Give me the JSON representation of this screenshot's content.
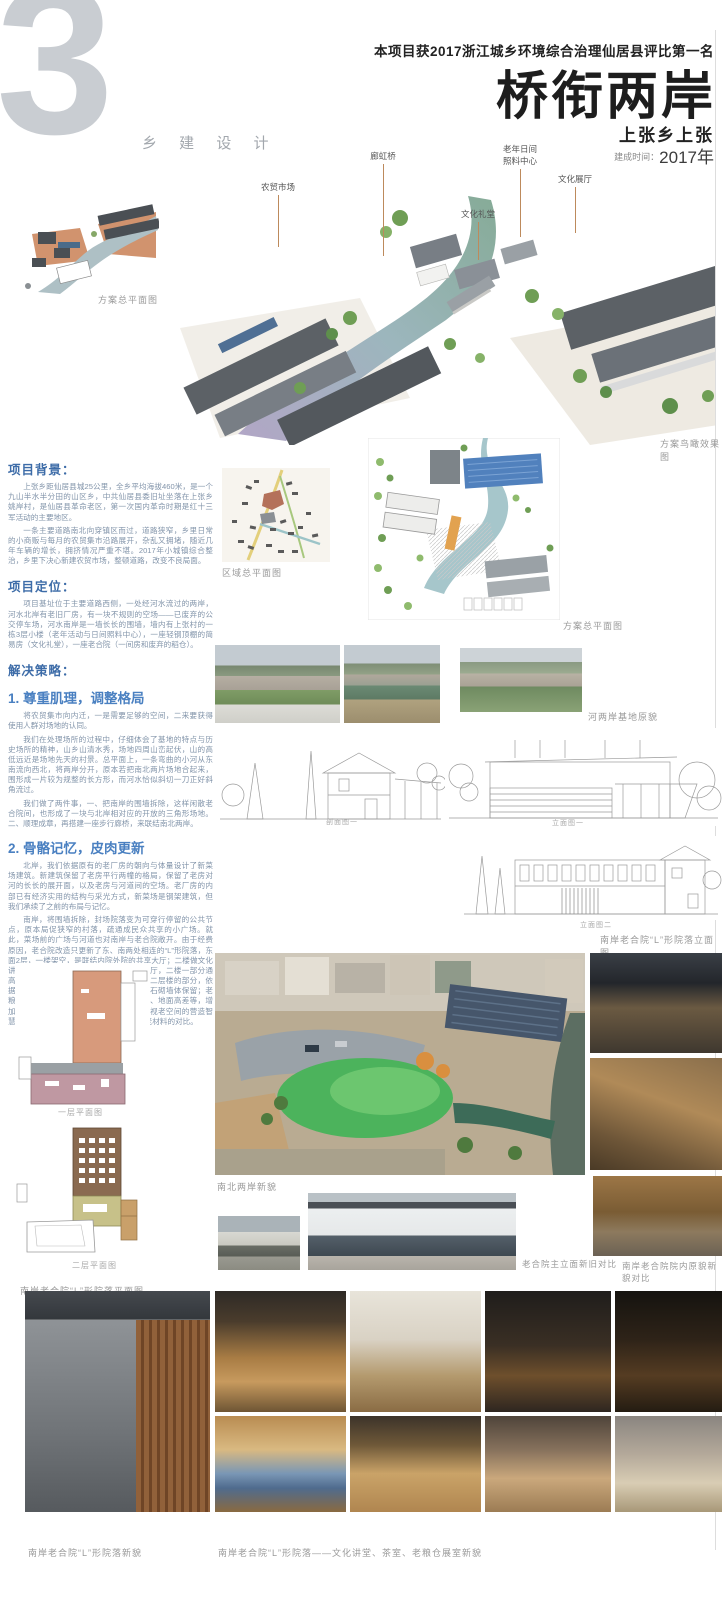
{
  "header": {
    "chapter_number": "3",
    "chapter_label": "乡 建 设 计",
    "award": "本项目获2017浙江城乡环境综合治理仙居县评比第一名",
    "title": "桥衔两岸",
    "subtitle": "上张乡上张",
    "date_label": "建成时间：",
    "date_value": "2017年"
  },
  "hero": {
    "caption": "方案鸟瞰效果图",
    "labels": [
      "农贸市场",
      "廊虹桥",
      "文化礼堂",
      "老年日间照料中心",
      "文化展厅"
    ]
  },
  "sections": {
    "background": {
      "title": "项目背景：",
      "p1": "上张乡距仙居县城25公里，全乡平均海拔460米，是一个九山半水半分田的山区乡，中共仙居县委旧址坐落在上张乡姚岸村，是仙居县革命老区，第一次国内革命时期是红十三军活动的主要地区。",
      "p2": "一条主要道路南北向穿镇区而过，道路狭窄，乡里日常的小商贩与每月的农贸集市沿路展开，杂乱又拥堵，随近几年车辆的增长，拥挤情况严重不堪。2017年小城镇综合整治，乡里下决心新建农贸市场，整顿道路，改变不良局面。"
    },
    "positioning": {
      "title": "项目定位：",
      "p1": "项目基址位于主要道路西侧，一处经河水流过的两岸，河水北岸有老旧厂房，有一块不规则的空场——已废弃的公交停车场，河水南岸是一墙长长的围墙，墙内有上张村的一栋3层小楼（老年活动与日间照料中心），一座轻钢顶棚的简易房（文化礼堂），一座老合院（一间房和废弃的稻仓）。"
    },
    "strategy": {
      "title": "解决策略：",
      "s1": {
        "title": "1. 尊重肌理，调整格局",
        "p1": "将农贸集市向内迁，一是需要足够的空间，二来要获得使用人群对场地的认同。",
        "p2": "我们在处理场所的过程中，仔细体会了基地的特点与历史场所的精神，山乡山清水秀，场地四周山峦起伏，山的高低远近是场地先天的村景。总平面上，一条弯曲的小河从东南流向西北，将两岸分开，原本若把南北两片场地合起来，围形成一片较为规整的长方形，而河水恰似斜切一刀正好斜角流过。",
        "p3": "我们做了两件事，一、把南岸的围墙拆除，这样闲散老合院间，也形成了一块与北岸相对应的开放的三角形场地。二、顺理成章，再搭建一座步行廊桥，来联结南北两岸。"
      },
      "s2": {
        "title": "2. 骨骼记忆，皮肉更新",
        "p1": "北岸，我们依据原有的老厂房的朝向与体量设计了新菜场建筑。新建筑保留了老房平行两幢的格局，保留了老房对河的长长的展开面，以及老房与河道间的空场。老厂房的内部已有经济实用的结构与采光方式，新菜场是钢架建筑，但我们承续了之前的布局与记忆。",
        "p2": "南岸，将围墙拆除，封场院落变为可穿行停留的公共节点，原本局促狭窄的村落，疏通成民众共享的小广场。就此，菜场前的广场与河道也对南岸与老合院敞开。由于经费原因，老合院改造只更新了东、南两处相连的“L”形院落，东面2层，一楼架空，是联结内院外院的共享大厅；二楼做文化讲堂与茶室。南座，一楼为村传统文化展厅，二楼一部分通高空间，另一部分为小型图书阅览室。有二层楼的部分，依据原本老屋木构测绘，改用钢结构新建，石砌墙体保留；老粮仓一层楼，则保留老屋木构，包括墙面、地面高差等，增加了屋顶与墙面的咬接自然采光，同样珍视老空间的营造智慧与记忆，同时也产生了新的空间感，新老材料的对比。"
      }
    }
  },
  "captions": {
    "plan_topleft": "方案总平面图",
    "regional": "区域总平面图",
    "master": "方案总平面图",
    "site_photos": "河两岸基地原貌",
    "section1": "剖面图一",
    "elevation1": "立面图一",
    "elevation2": "立面图二",
    "l_elevation": "南岸老合院“L”形院落立面图",
    "floor1": "一层平面图",
    "floor2": "二层平面图",
    "l_plan": "南岸老合院“L”形院落平面图",
    "aerial": "南北两岸新貌",
    "facade_compare": "老合院主立面新旧对比",
    "courtyard_compare": "南岸老合院院内原貌新貌对比",
    "bottom_left": "南岸老合院“L”形院落新貌",
    "bottom_right": "南岸老合院“L”形院落——文化讲堂、茶室、老粮仓展室新貌"
  },
  "colors": {
    "heading_blue": "#3d6ca8",
    "subheading_blue": "#4a80c1",
    "body_text": "#8294aa",
    "leader_line": "#bd8a5c",
    "pool_green": "#4cb35c",
    "river_teal": "#9bbcc0",
    "plan_salmon": "#d79a7c",
    "plan_mauve": "#bf98a2",
    "plan_brown": "#8a6a50",
    "plan_olive": "#c7c189"
  }
}
